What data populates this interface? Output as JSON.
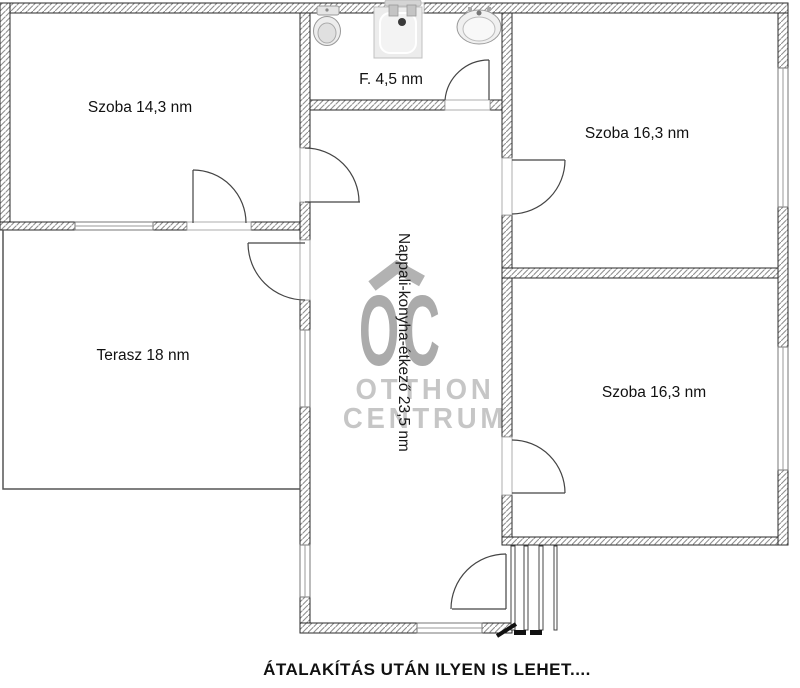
{
  "floorplan": {
    "rooms": [
      {
        "name": "szoba-top-left",
        "label": "Szoba 14,3 nm"
      },
      {
        "name": "bathroom",
        "label": "F. 4,5 nm"
      },
      {
        "name": "szoba-top-right",
        "label": "Szoba 16,3 nm"
      },
      {
        "name": "szoba-bottom-right",
        "label": "Szoba 16,3 nm"
      },
      {
        "name": "terasz",
        "label": "Terasz 18 nm"
      },
      {
        "name": "nappali",
        "label": "Nappali-konyha-étkező 23,5 nm"
      }
    ],
    "watermark": {
      "logo": "OC",
      "line1": "OTTHON",
      "line2": "CENTRUM",
      "logo_color": "#ababab",
      "text_color": "#c6c6c6",
      "chevron_color": "#b2b2b2"
    },
    "caption": "ÁTALAKÍTÁS UTÁN ILYEN IS LEHET....",
    "fixtures": [
      {
        "name": "toilet"
      },
      {
        "name": "shower"
      },
      {
        "name": "sink"
      }
    ],
    "colors": {
      "wall_hatch_line": "#8f8f8f",
      "wall_edge": "#2a2a2a",
      "thin_line": "#555555",
      "door_line": "#444444",
      "background": "#ffffff",
      "label_text": "#111111"
    }
  }
}
